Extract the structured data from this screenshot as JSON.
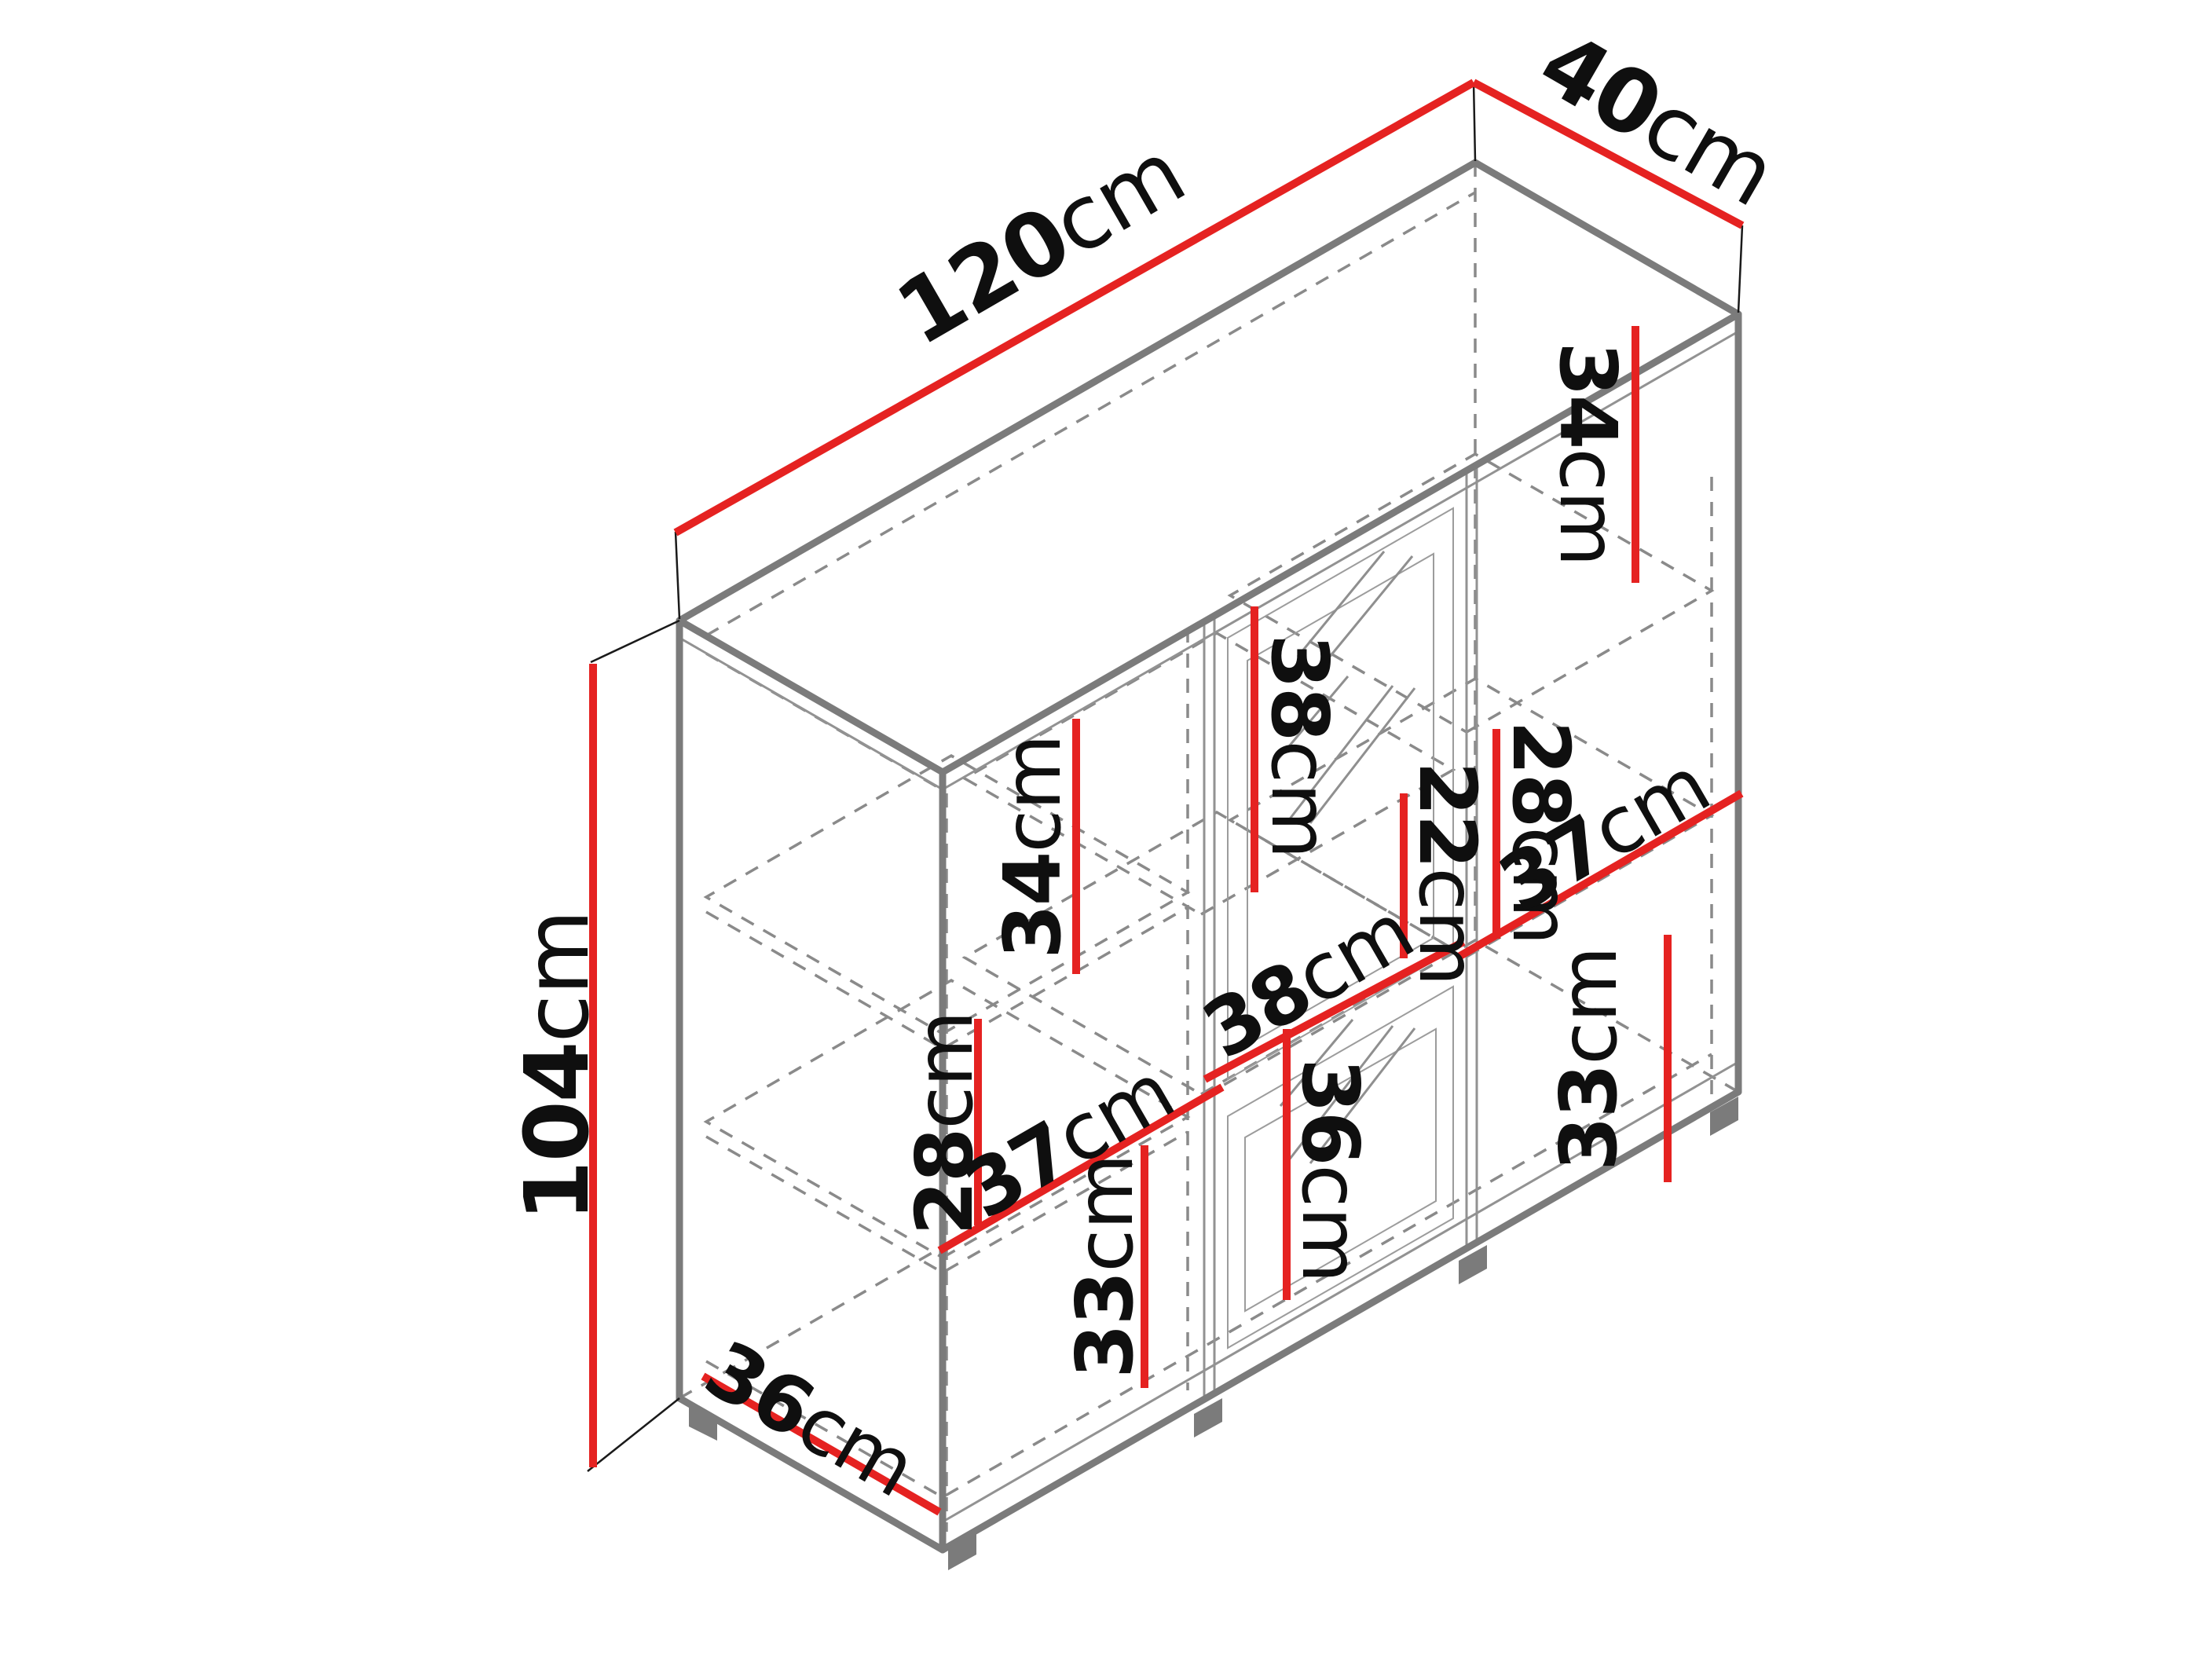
{
  "diagram": {
    "type": "isometric-dimension-drawing",
    "subject": "sideboard cabinet with three columns and glass center doors",
    "unit": "cm",
    "background": "#ffffff"
  },
  "colors": {
    "dimension_line_red": "#e52221",
    "cabinet_edge_gray": "#7b7b7b",
    "hidden_edge_gray": "#8a8a8a",
    "label_black": "#0f0f0f"
  },
  "furniture": {
    "overall": {
      "width_cm": 120,
      "depth_cm": 40,
      "height_cm": 104
    },
    "interior": {
      "left_column": {
        "width_cm": 37,
        "section_heights_top_to_bottom_cm": [
          34,
          28,
          33
        ]
      },
      "center_column": {
        "width_cm": 38,
        "section_heights_top_to_bottom_cm": [
          38,
          22,
          36
        ]
      },
      "right_column": {
        "width_cm": 37,
        "section_heights_top_to_bottom_cm": [
          34,
          28,
          33
        ]
      },
      "interior_depth_cm": 36
    }
  },
  "dims": {
    "d120": {
      "num": "120",
      "unit": "cm",
      "value": 120,
      "measures": "overall width (top edge)"
    },
    "d40": {
      "num": "40",
      "unit": "cm",
      "value": 40,
      "measures": "overall depth (top edge)"
    },
    "d104": {
      "num": "104",
      "unit": "cm",
      "value": 104,
      "measures": "overall height (left edge)"
    },
    "d34r": {
      "num": "34",
      "unit": "cm",
      "value": 34,
      "measures": "right column top section height"
    },
    "d38c": {
      "num": "38",
      "unit": "cm",
      "value": 38,
      "measures": "center column top section height"
    },
    "d34l": {
      "num": "34",
      "unit": "cm",
      "value": 34,
      "measures": "left column top section height"
    },
    "d28r": {
      "num": "28",
      "unit": "cm",
      "value": 28,
      "measures": "right column middle section height"
    },
    "d22c": {
      "num": "22",
      "unit": "cm",
      "value": 22,
      "measures": "center column middle section height"
    },
    "d37r": {
      "num": "37",
      "unit": "cm",
      "value": 37,
      "measures": "right column interior width"
    },
    "d38cd": {
      "num": "38",
      "unit": "cm",
      "value": 38,
      "measures": "center column interior width"
    },
    "d28l": {
      "num": "28",
      "unit": "cm",
      "value": 28,
      "measures": "left column middle section height"
    },
    "d37l": {
      "num": "37",
      "unit": "cm",
      "value": 37,
      "measures": "left column interior width"
    },
    "d33l": {
      "num": "33",
      "unit": "cm",
      "value": 33,
      "measures": "left column bottom section height"
    },
    "d36c": {
      "num": "36",
      "unit": "cm",
      "value": 36,
      "measures": "center column bottom section height"
    },
    "d33r": {
      "num": "33",
      "unit": "cm",
      "value": 33,
      "measures": "right column bottom section height"
    },
    "d36b": {
      "num": "36",
      "unit": "cm",
      "value": 36,
      "measures": "interior depth (bottom edge)"
    }
  }
}
